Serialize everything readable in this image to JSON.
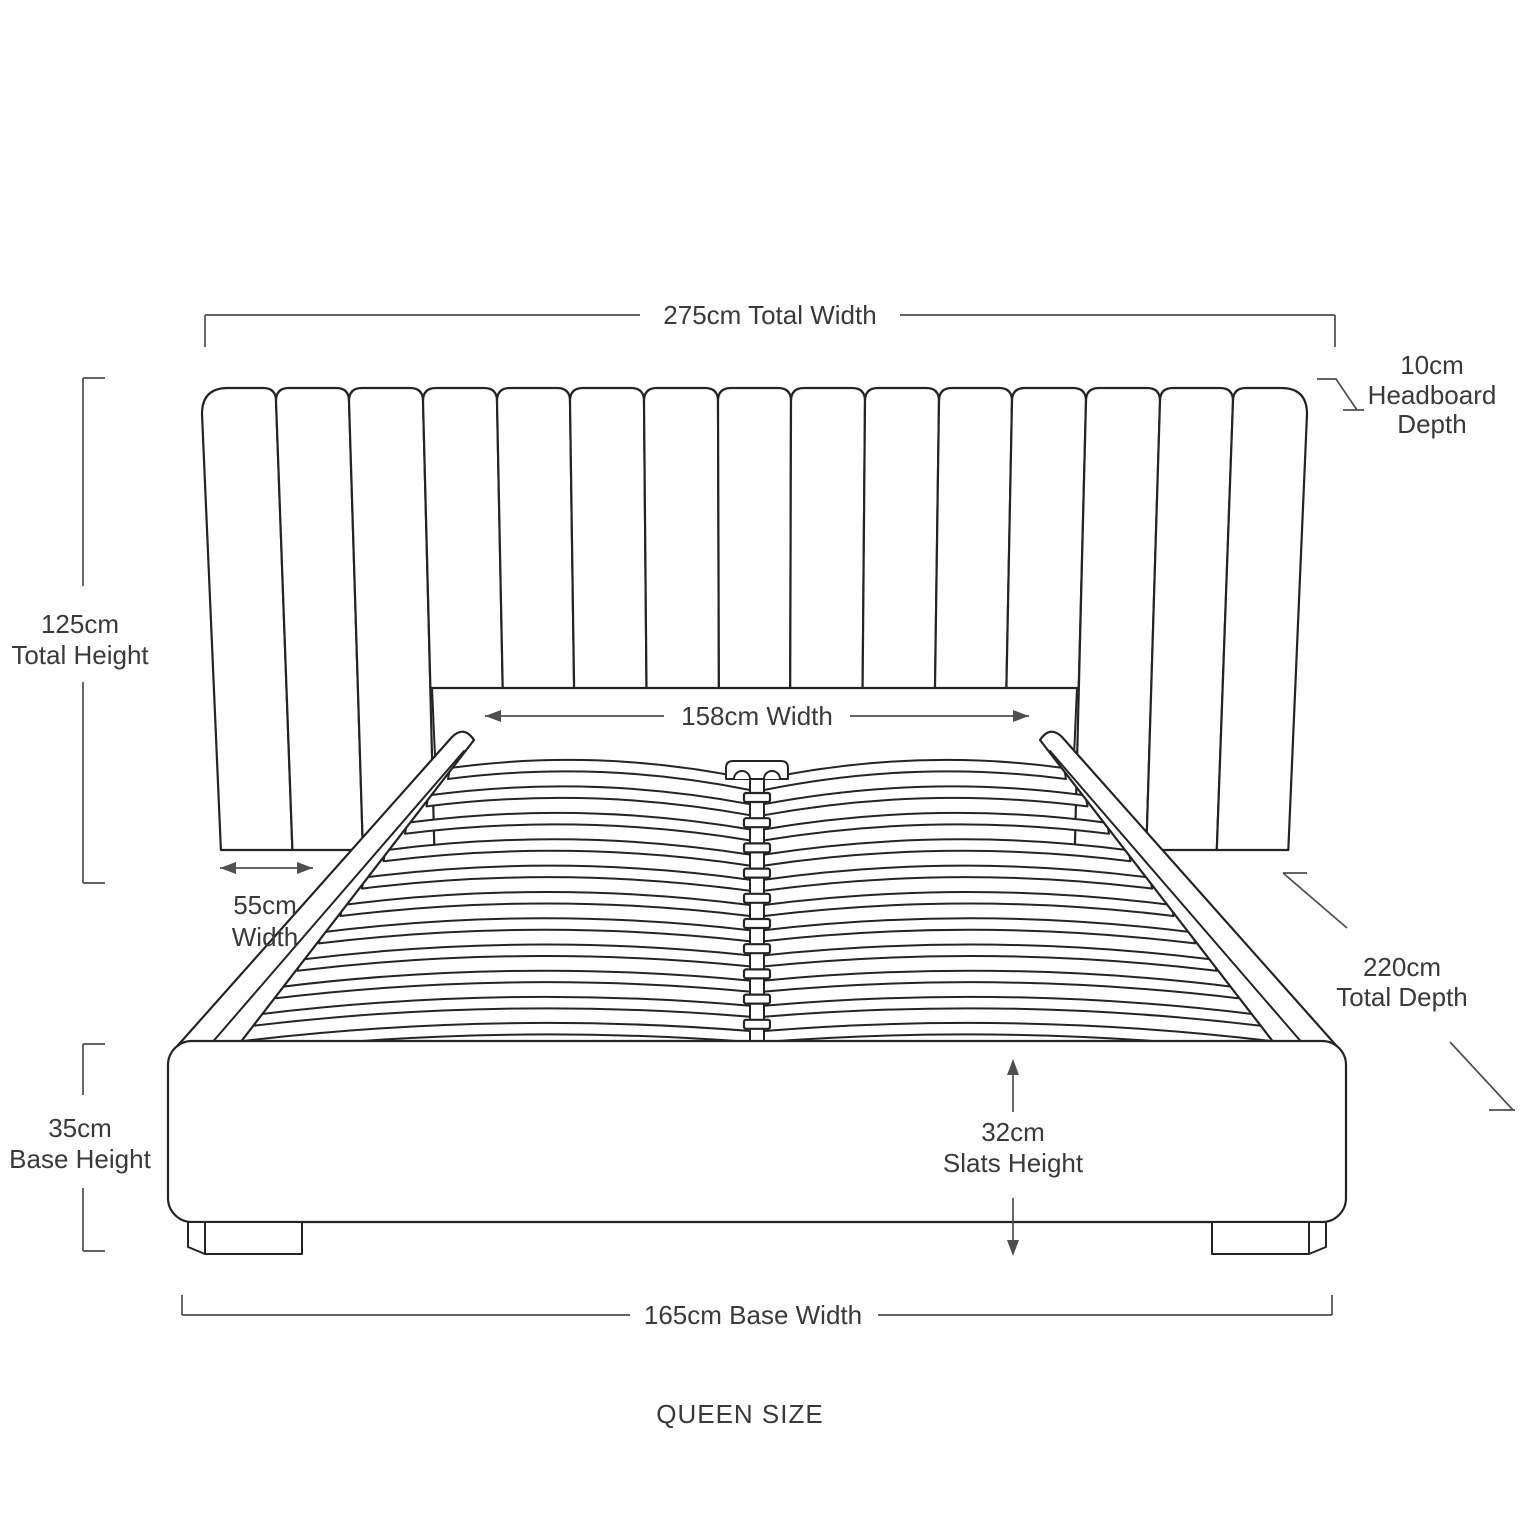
{
  "diagram": {
    "product": "upholstered bed with slatted base",
    "size_label": "QUEEN SIZE",
    "labels": {
      "total_width": "275cm Total Width",
      "headboard_depth_l1": "10cm",
      "headboard_depth_l2": "Headboard",
      "headboard_depth_l3": "Depth",
      "total_height_l1": "125cm",
      "total_height_l2": "Total Height",
      "inner_width": "158cm Width",
      "wing_width_l1": "55cm",
      "wing_width_l2": "Width",
      "total_depth_l1": "220cm",
      "total_depth_l2": "Total Depth",
      "base_height_l1": "35cm",
      "base_height_l2": "Base Height",
      "slats_height_l1": "32cm",
      "slats_height_l2": "Slats Height",
      "base_width": "165cm Base Width"
    },
    "colors": {
      "art_line": "#242424",
      "dimension_line": "#4f4f4f",
      "text": "#3a3a3a",
      "background": "#ffffff"
    }
  }
}
